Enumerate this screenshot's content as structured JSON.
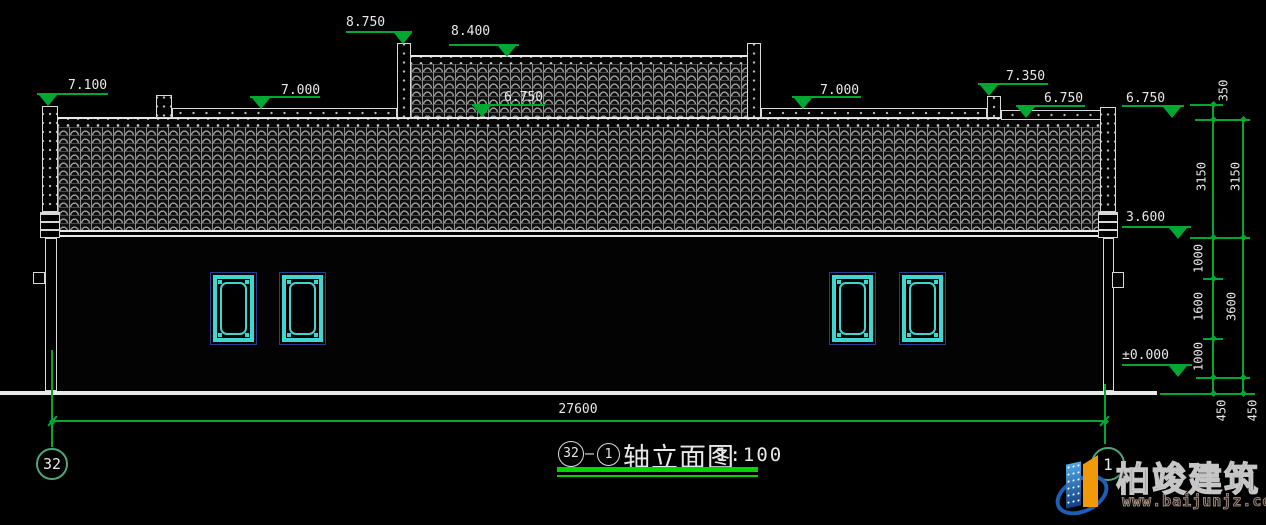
{
  "colors": {
    "background": "#000000",
    "cad_green": "#00a832",
    "title_underline_green": "#00d400",
    "axis_bubble_teal": "#4ea57c",
    "line_white": "#e8e8e8",
    "window_cyan": "#3fd6cf",
    "window_blue": "#2a3e8f",
    "logo_blue": "#1c5fb5",
    "logo_orange": "#f09a0a"
  },
  "elevations": {
    "v8750": "8.750",
    "v8400": "8.400",
    "v7100": "7.100",
    "v7000_left": "7.000",
    "v6750_center": "6.750",
    "v7000_right": "7.000",
    "v7350": "7.350",
    "v6750_right_inner": "6.750",
    "v6750_right_outer": "6.750",
    "v3600": "3.600",
    "v0000": "±0.000"
  },
  "dims": {
    "total_width": "27600",
    "right_inner": [
      "350",
      "3150",
      "1000",
      "1600",
      "1000",
      "450"
    ],
    "right_outer": [
      "3150",
      "3600",
      "450"
    ]
  },
  "axes": {
    "left_bubble": "32",
    "right_bubble": "1"
  },
  "title": {
    "bubble_start": "32",
    "separator": "–",
    "bubble_end": "1",
    "text": "轴立面图",
    "scale": "1:100"
  },
  "watermark": {
    "brand": "柏竣建筑",
    "url": "www.baijunjz.com"
  }
}
